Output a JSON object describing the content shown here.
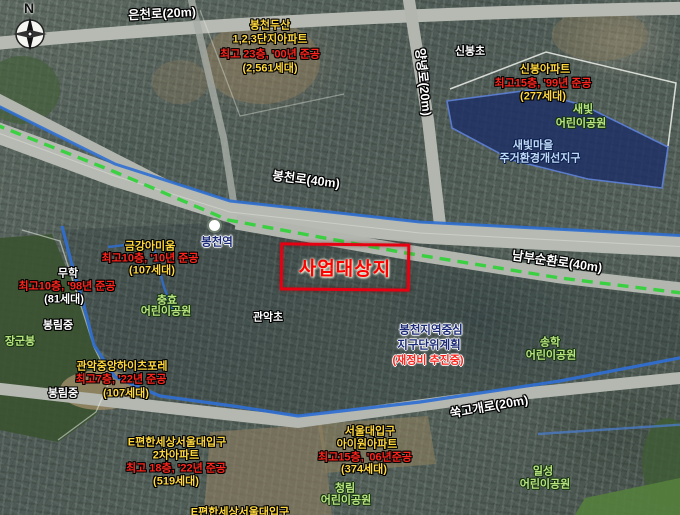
{
  "compass": {
    "north": "N"
  },
  "roads": {
    "eunchon": "은천로(20m)",
    "bongcheon": "봉천로(40m)",
    "yangnyeong": "양녕로(20m)",
    "nambu_sunhwan": "남부순환로(40m)",
    "sukgogae": "쑥고개로(20m)"
  },
  "station": {
    "name": "봉천역"
  },
  "site": {
    "label": "사업대상지"
  },
  "districts": {
    "saebit_village": {
      "line1": "새빛마을",
      "line2": "주거환경개선지구"
    },
    "bongcheon_center": {
      "line1": "봉천지역중심",
      "line2": "지구단위계획",
      "line3": "(재정비 추진중)"
    }
  },
  "apartments": {
    "bongcheon_dusan": {
      "name1": "봉천두산",
      "name2": "1,2,3단지아파트",
      "spec": "최고 23층, '00년 준공",
      "units": "(2,561세대)"
    },
    "sinbong": {
      "name1": "신봉아파트",
      "spec": "최고15층, '99년 준공",
      "units": "(277세대)"
    },
    "geumgang_amium": {
      "name1": "금강아미움",
      "spec": "최고10층, '10년 준공",
      "units": "(107세대)"
    },
    "muhak": {
      "name1": "무학",
      "spec": "최고10층, '98년 준공",
      "units": "(81세대)"
    },
    "gwanak_heights": {
      "name1": "관악중앙하이츠포레",
      "spec": "최고7층, '22년 준공",
      "units": "(107세대)"
    },
    "epyeonhan_2cha": {
      "name1": "E편한세상서울대입구",
      "name2": "2차아파트",
      "spec": "최고 18층, '22년 준공",
      "units": "(519세대)"
    },
    "iwon": {
      "name1": "서울대입구",
      "name2": "아이원아파트",
      "spec": "최고15층, '06년준공",
      "units": "(374세대)"
    },
    "epyeonhan_partial": "E편한세상서울대입구"
  },
  "schools": {
    "sinbong_cho": "신봉초",
    "gwanak_cho": "관악초",
    "bongnim_mid_a": "봉림중",
    "bongnim_mid_b": "봉림중"
  },
  "parks": {
    "saebit": {
      "line1": "새빛",
      "line2": "어린이공원"
    },
    "chunghyo": {
      "line1": "충효",
      "line2": "어린이공원"
    },
    "songhak": {
      "line1": "송학",
      "line2": "어린이공원"
    },
    "cheongnim": {
      "line1": "청림",
      "line2": "어린이공원"
    },
    "ilseong": {
      "line1": "일성",
      "line2": "어린이공원"
    },
    "janggunbong": "장군봉"
  },
  "colors": {
    "label_yellow": "#ffd83d",
    "label_red": "#ff241c",
    "label_green": "#b9e57f",
    "label_navy": "#1b2a77",
    "label_lightblue": "#bfdcf7",
    "site_red": "#e60012",
    "metro_green": "#35d23c",
    "boundary_blue": "#2f6fd2",
    "district_fill": "#1c2e66"
  }
}
